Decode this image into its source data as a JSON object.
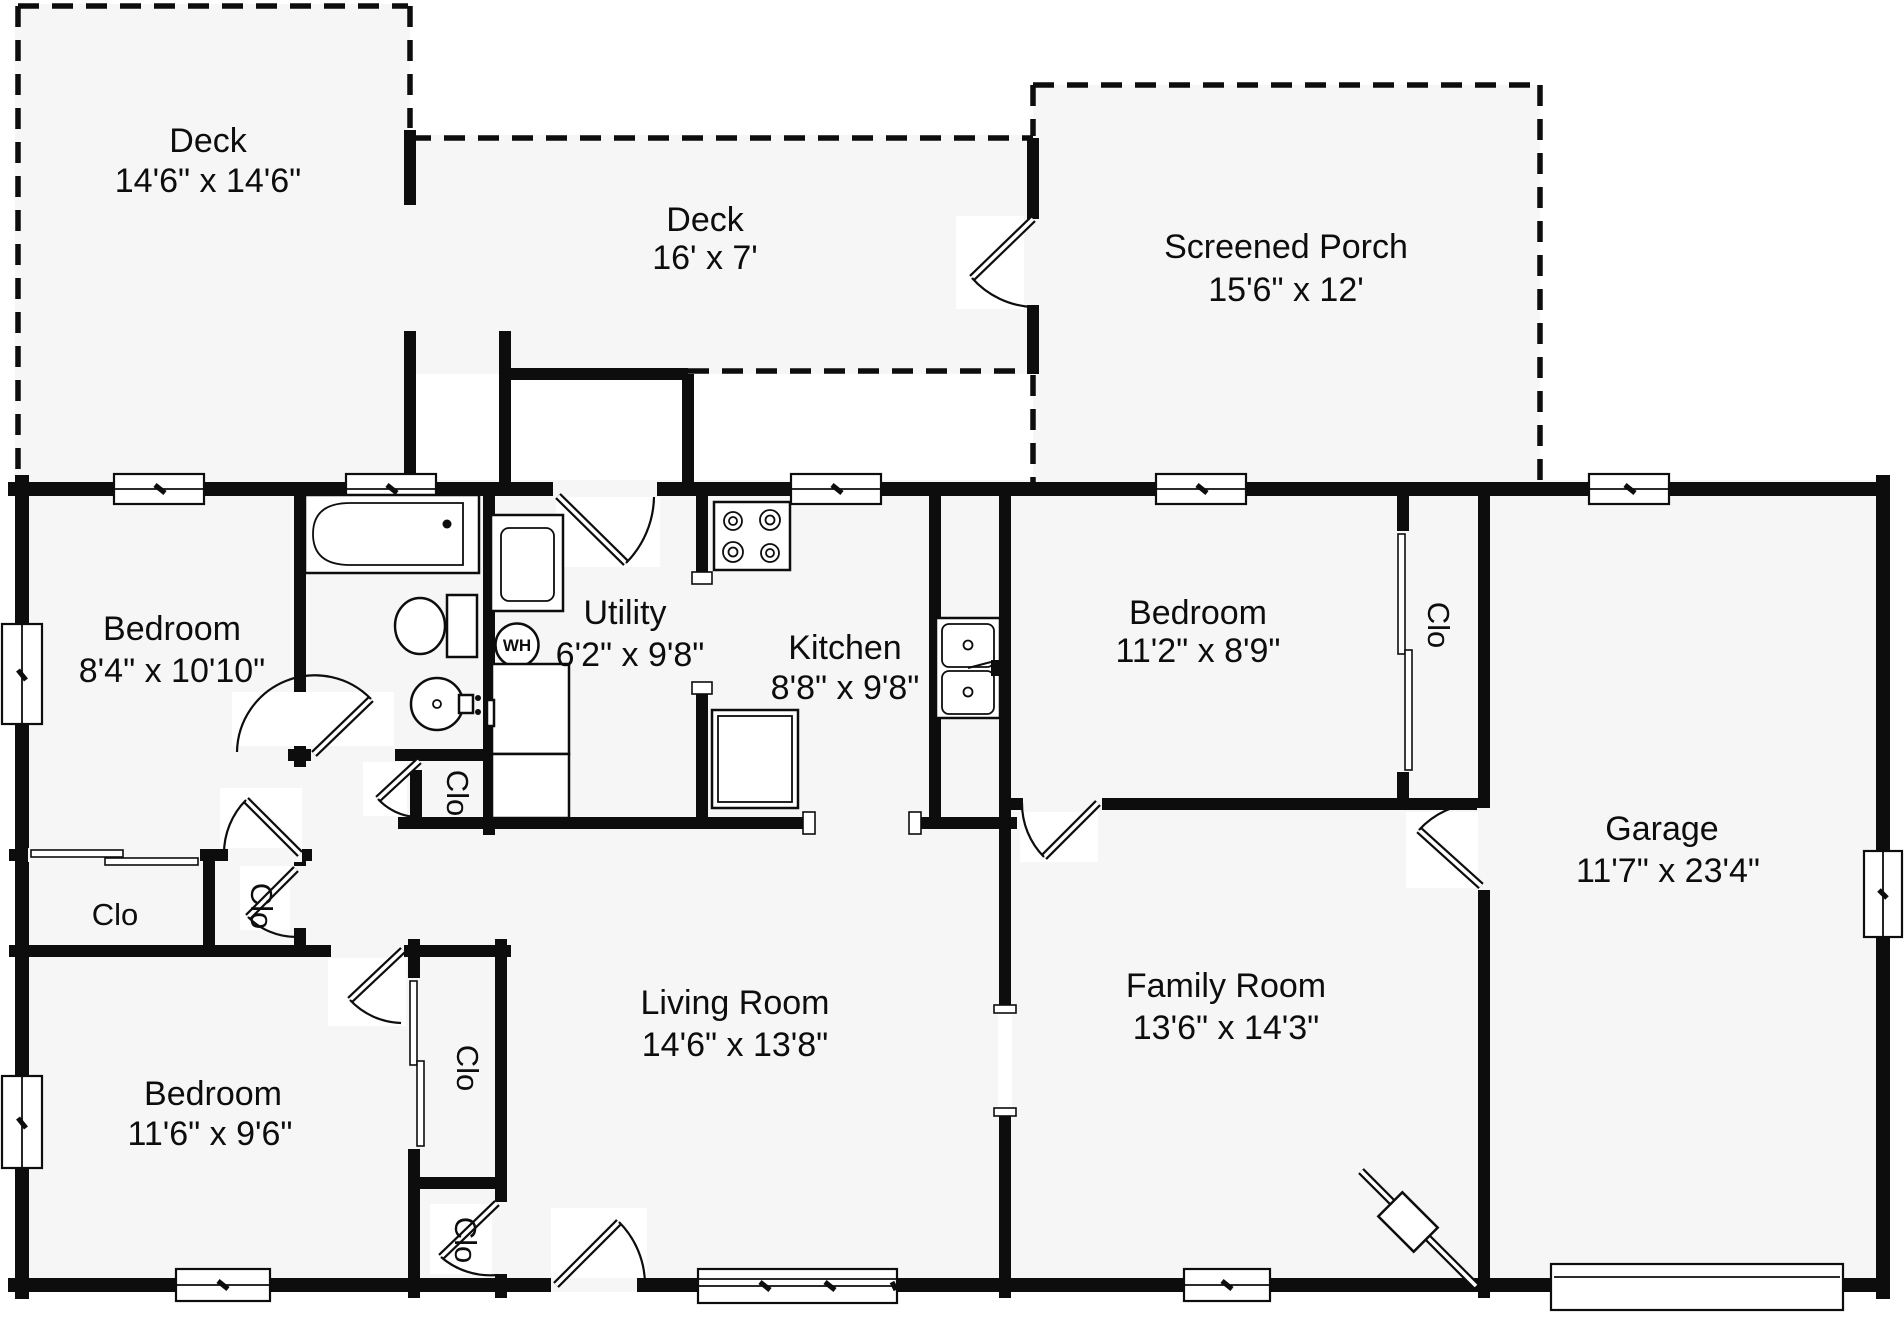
{
  "colors": {
    "background": "#ffffff",
    "walls": "#0d0d0d",
    "floor": "#f6f6f6"
  },
  "rooms": [
    {
      "name": "Deck",
      "dims": "14'6\" x 14'6\""
    },
    {
      "name": "Deck",
      "dims": "16' x 7'"
    },
    {
      "name": "Screened Porch",
      "dims": "15'6\" x 12'"
    },
    {
      "name": "Bedroom",
      "dims": "8'4\" x 10'10\""
    },
    {
      "name": "Utility",
      "dims": "6'2\" x 9'8\""
    },
    {
      "name": "Kitchen",
      "dims": "8'8\" x 9'8\""
    },
    {
      "name": "Bedroom",
      "dims": "11'2\" x 8'9\""
    },
    {
      "name": "Garage",
      "dims": "11'7\" x 23'4\""
    },
    {
      "name": "Bedroom",
      "dims": "11'6\" x 9'6\""
    },
    {
      "name": "Living Room",
      "dims": "14'6\" x 13'8\""
    },
    {
      "name": "Family Room",
      "dims": "13'6\" x 14'3\""
    }
  ],
  "closet_label": "Clo",
  "water_heater_label": "WH"
}
